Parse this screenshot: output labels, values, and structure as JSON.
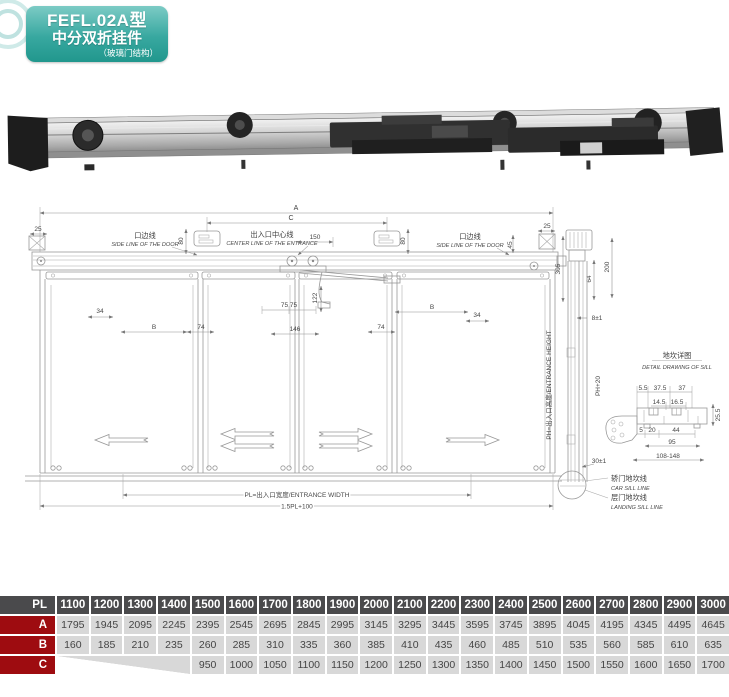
{
  "badge": {
    "model": "FEFL.02A型",
    "name": "中分双折挂件",
    "sub": "（玻璃门结构）"
  },
  "colors": {
    "badge_teal": "#2ea79e",
    "table_header_gray": "#4a4a4c",
    "table_label_red": "#9e0c10",
    "table_cell_gray": "#d8d8d8"
  },
  "drawing": {
    "dim_a": "A",
    "dim_c": "C",
    "dim_25": "25",
    "dim_45": "45",
    "dim_80": "80",
    "dim_150": "150",
    "dim_34": "34",
    "dim_b": "B",
    "dim_74": "74",
    "dim_7575": "75 75",
    "dim_122": "122",
    "dim_146": "146",
    "side_line_cn": "口边线",
    "side_line_en": "SIDE LINE OF THE DOOR",
    "center_line_cn": "出入口中心线",
    "center_line_en": "CENTER LINE OF THE ENTRANCE",
    "entrance_width": "PL=出入口宽度/ENTRANCE WIDTH",
    "total_width": "1.5PL+100"
  },
  "section": {
    "dim_305": "305",
    "dim_200": "200",
    "dim_64": "64",
    "dim_8": "8±1",
    "dim_30": "30±1",
    "entrance_height": "PH=出入口高度/ENTRANCE HEIGHT",
    "ph20": "PH+20",
    "car_sill_cn": "轿门地坎线",
    "car_sill_en": "CAR SILL LINE",
    "landing_sill_cn": "层门地坎线",
    "landing_sill_en": "LANDING SILL LINE"
  },
  "sill": {
    "title_cn": "地坎详图",
    "title_en": "DETAIL DRAWING OF SILL",
    "d1": "5.5",
    "d2": "37.5",
    "d3": "37",
    "d4": "14.5",
    "d5": "16.5",
    "d6": "25.5",
    "d7": "5",
    "d8": "20",
    "d9": "44",
    "d10": "95",
    "d11": "108-148"
  },
  "table": {
    "header_label": "PL",
    "columns": [
      "1100",
      "1200",
      "1300",
      "1400",
      "1500",
      "1600",
      "1700",
      "1800",
      "1900",
      "2000",
      "2100",
      "2200",
      "2300",
      "2400",
      "2500",
      "2600",
      "2700",
      "2800",
      "2900",
      "3000"
    ],
    "rows": [
      {
        "label": "A",
        "merged_empty": 0,
        "values": [
          "1795",
          "1945",
          "2095",
          "2245",
          "2395",
          "2545",
          "2695",
          "2845",
          "2995",
          "3145",
          "3295",
          "3445",
          "3595",
          "3745",
          "3895",
          "4045",
          "4195",
          "4345",
          "4495",
          "4645"
        ]
      },
      {
        "label": "B",
        "merged_empty": 0,
        "values": [
          "160",
          "185",
          "210",
          "235",
          "260",
          "285",
          "310",
          "335",
          "360",
          "385",
          "410",
          "435",
          "460",
          "485",
          "510",
          "535",
          "560",
          "585",
          "610",
          "635"
        ]
      },
      {
        "label": "C",
        "merged_empty": 4,
        "values": [
          "",
          "",
          "",
          "",
          "950",
          "1000",
          "1050",
          "1100",
          "1150",
          "1200",
          "1250",
          "1300",
          "1350",
          "1400",
          "1450",
          "1500",
          "1550",
          "1600",
          "1650",
          "1700"
        ]
      }
    ]
  }
}
